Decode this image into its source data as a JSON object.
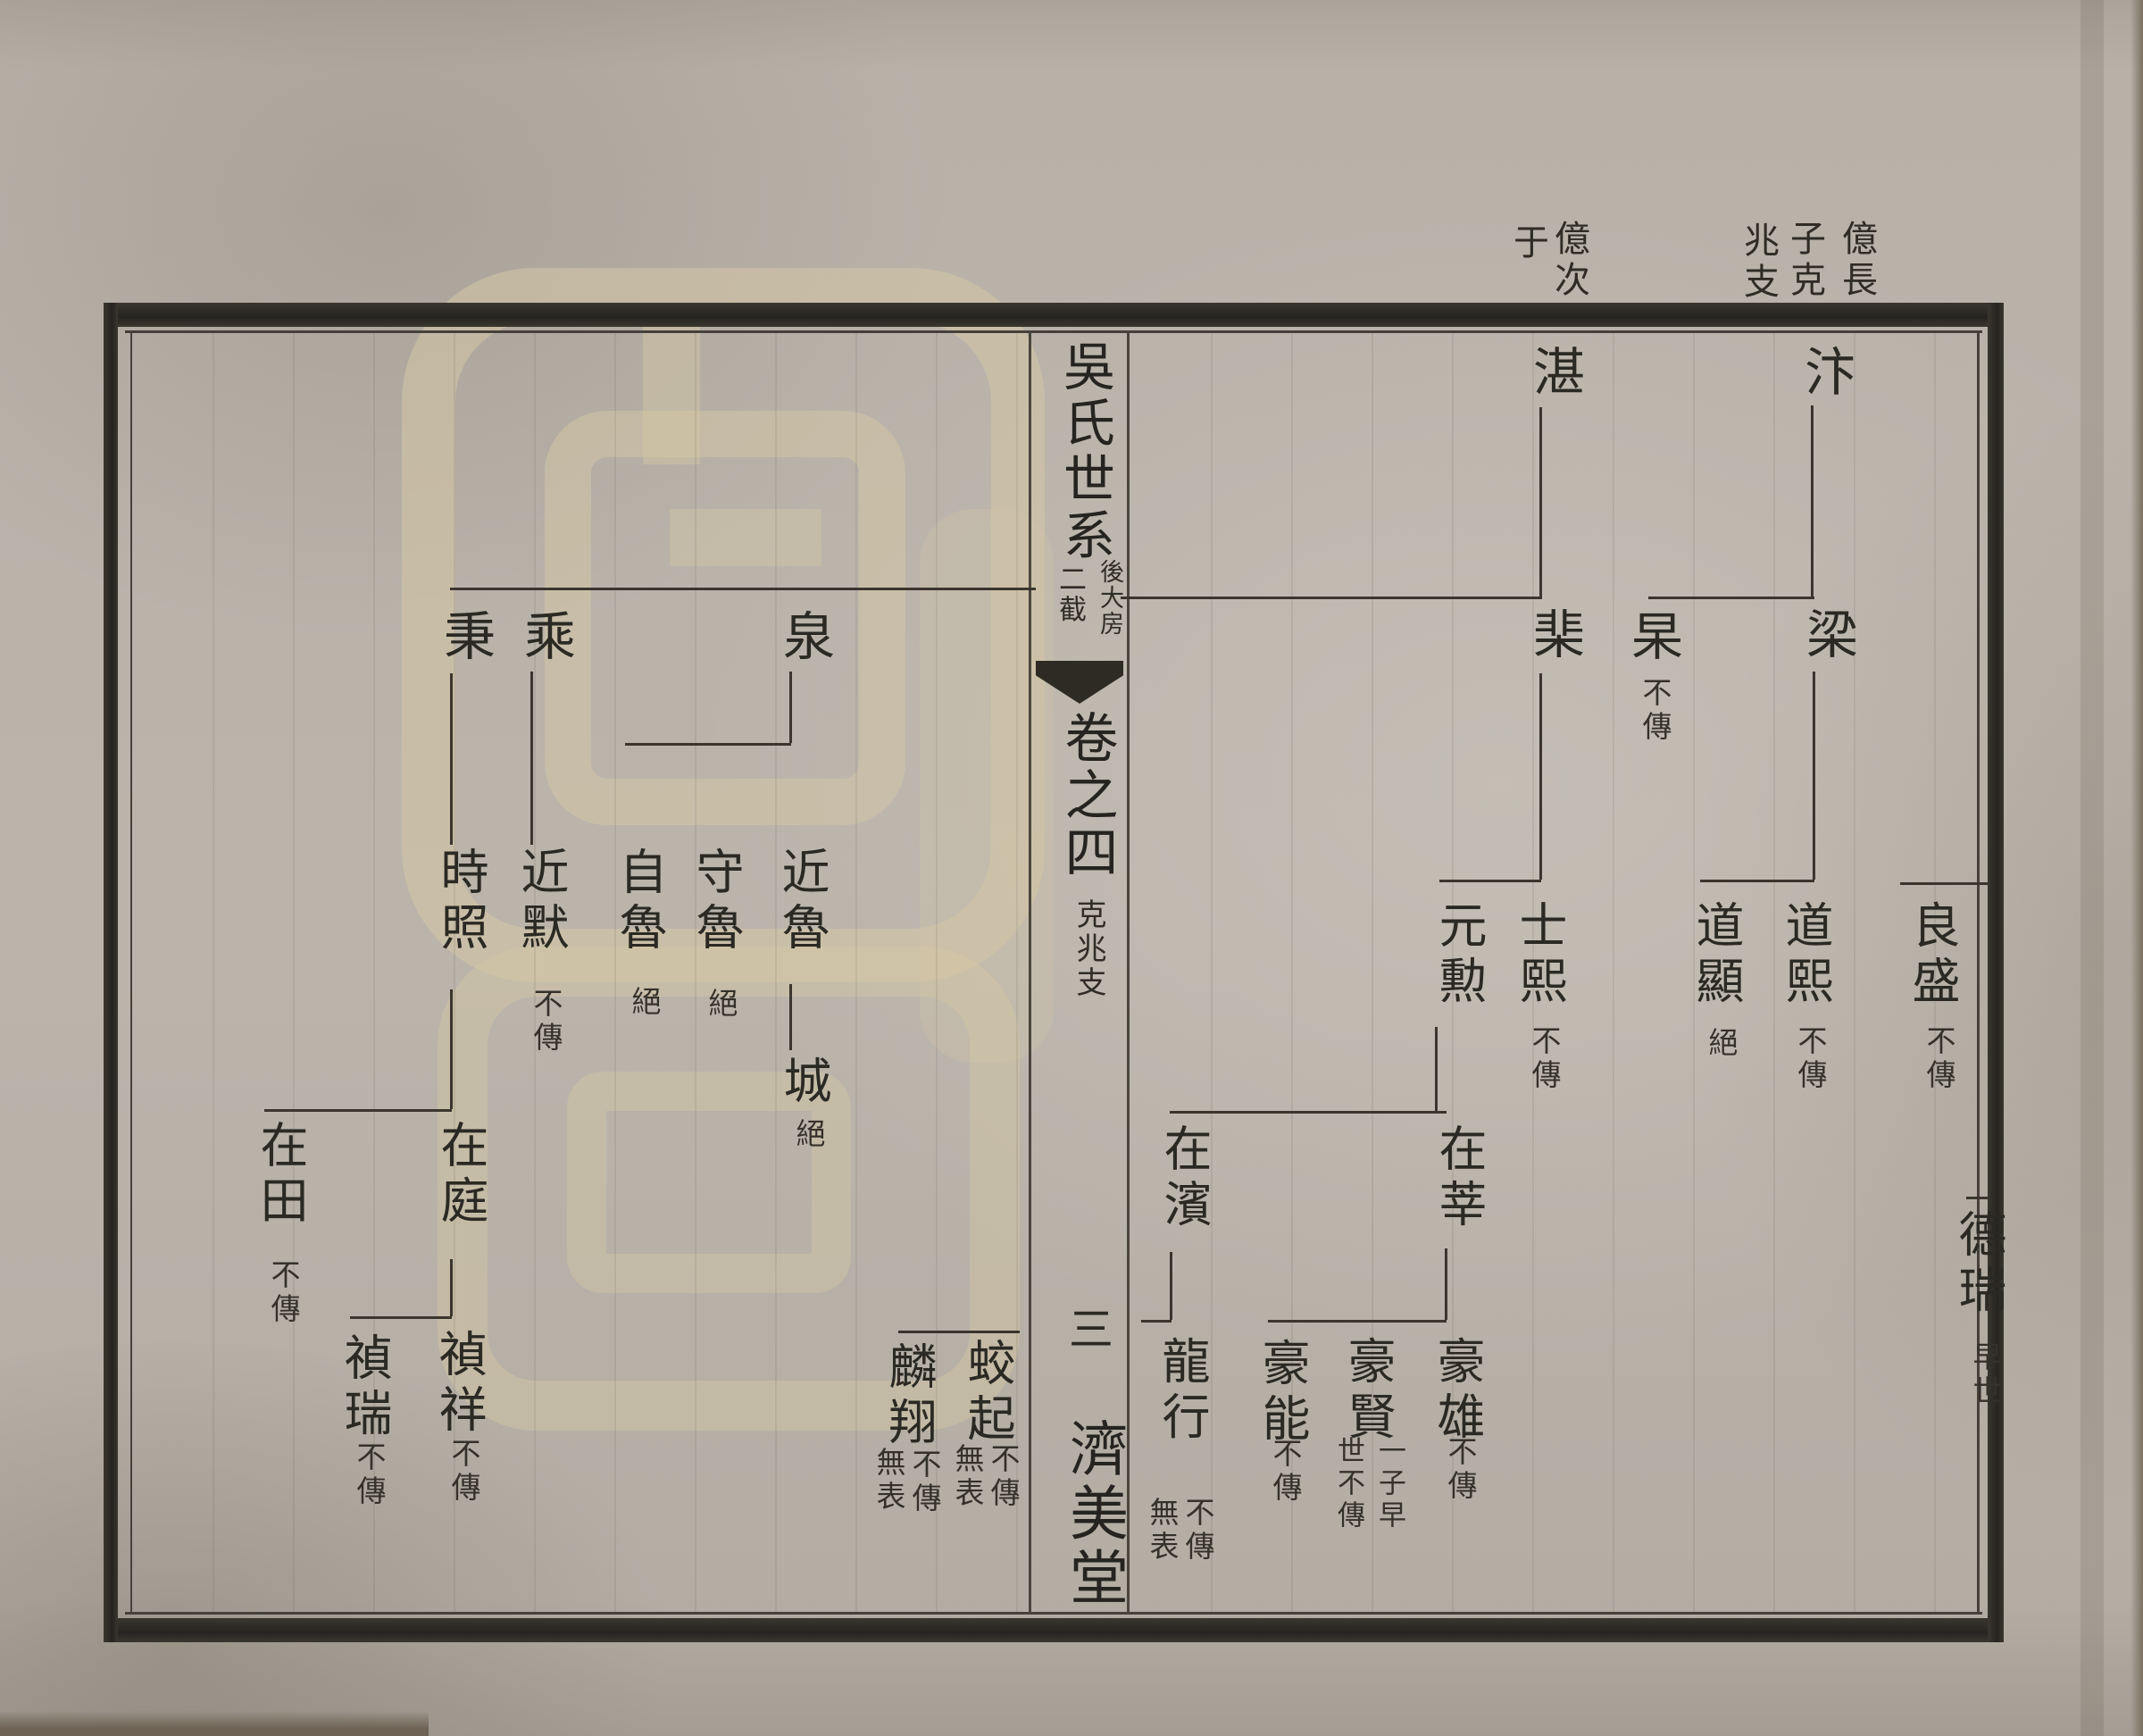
{
  "document": {
    "kind": "genealogy-chart-spread",
    "headers": {
      "right_branch": {
        "cols": [
          "億長",
          "子克",
          "兆支"
        ],
        "full": "億長子克兆支"
      },
      "left_branch": {
        "cols": [
          "億次",
          "于"
        ],
        "full": "億次于"
      }
    },
    "spine": {
      "title": "吳氏世系",
      "section_right": "後大房",
      "section_left": "二截",
      "volume": "卷之四",
      "branch": "克兆支",
      "page_number": "三",
      "hall_mark": "濟美堂"
    },
    "colors": {
      "paper": "#b7b1a8",
      "ink": "#2b2923",
      "watermark": "#d5c7a9"
    }
  },
  "tree": {
    "right_page": {
      "gen1": [
        {
          "name": "汴"
        },
        {
          "name": "湛"
        }
      ],
      "gen2": [
        {
          "name": "梁"
        },
        {
          "name": "杲",
          "note": "不傳"
        },
        {
          "name": "棐"
        }
      ],
      "gen3": [
        {
          "name": "良盛",
          "note": "不傳"
        },
        {
          "name": "道熙",
          "note": "不傳"
        },
        {
          "name": "道顯",
          "note": "絕"
        },
        {
          "name": "士熙",
          "note": "不傳"
        },
        {
          "name": "元勲"
        }
      ],
      "gen4": [
        {
          "name": "德瑞",
          "note": "早世"
        },
        {
          "name": "在莘"
        },
        {
          "name": "在濱"
        }
      ],
      "gen5": [
        {
          "name": "豪雄",
          "note": "不傳"
        },
        {
          "name": "豪賢",
          "note_cols": [
            "一子早",
            "世不傳"
          ]
        },
        {
          "name": "豪能",
          "note": "不傳"
        },
        {
          "name": "龍行",
          "note_cols": [
            "不傳",
            "無表"
          ]
        },
        {
          "name": "蛟起",
          "note_cols": [
            "不傳",
            "無表"
          ]
        },
        {
          "name": "麟翔",
          "note_cols": [
            "不傳",
            "無表"
          ]
        }
      ]
    },
    "left_page": {
      "gen2": [
        {
          "name": "泉"
        },
        {
          "name": "乘"
        },
        {
          "name": "秉"
        }
      ],
      "gen3": [
        {
          "name": "近魯"
        },
        {
          "name": "守魯",
          "note": "絕"
        },
        {
          "name": "自魯",
          "note": "絕"
        },
        {
          "name": "近默",
          "note": "不傳"
        },
        {
          "name": "時照"
        }
      ],
      "gen4": [
        {
          "name": "城",
          "note": "絕"
        },
        {
          "name": "在庭"
        },
        {
          "name": "在田",
          "note": "不傳"
        }
      ],
      "gen5": [
        {
          "name": "禎祥",
          "note": "不傳"
        },
        {
          "name": "禎瑞",
          "note": "不傳"
        }
      ]
    }
  }
}
